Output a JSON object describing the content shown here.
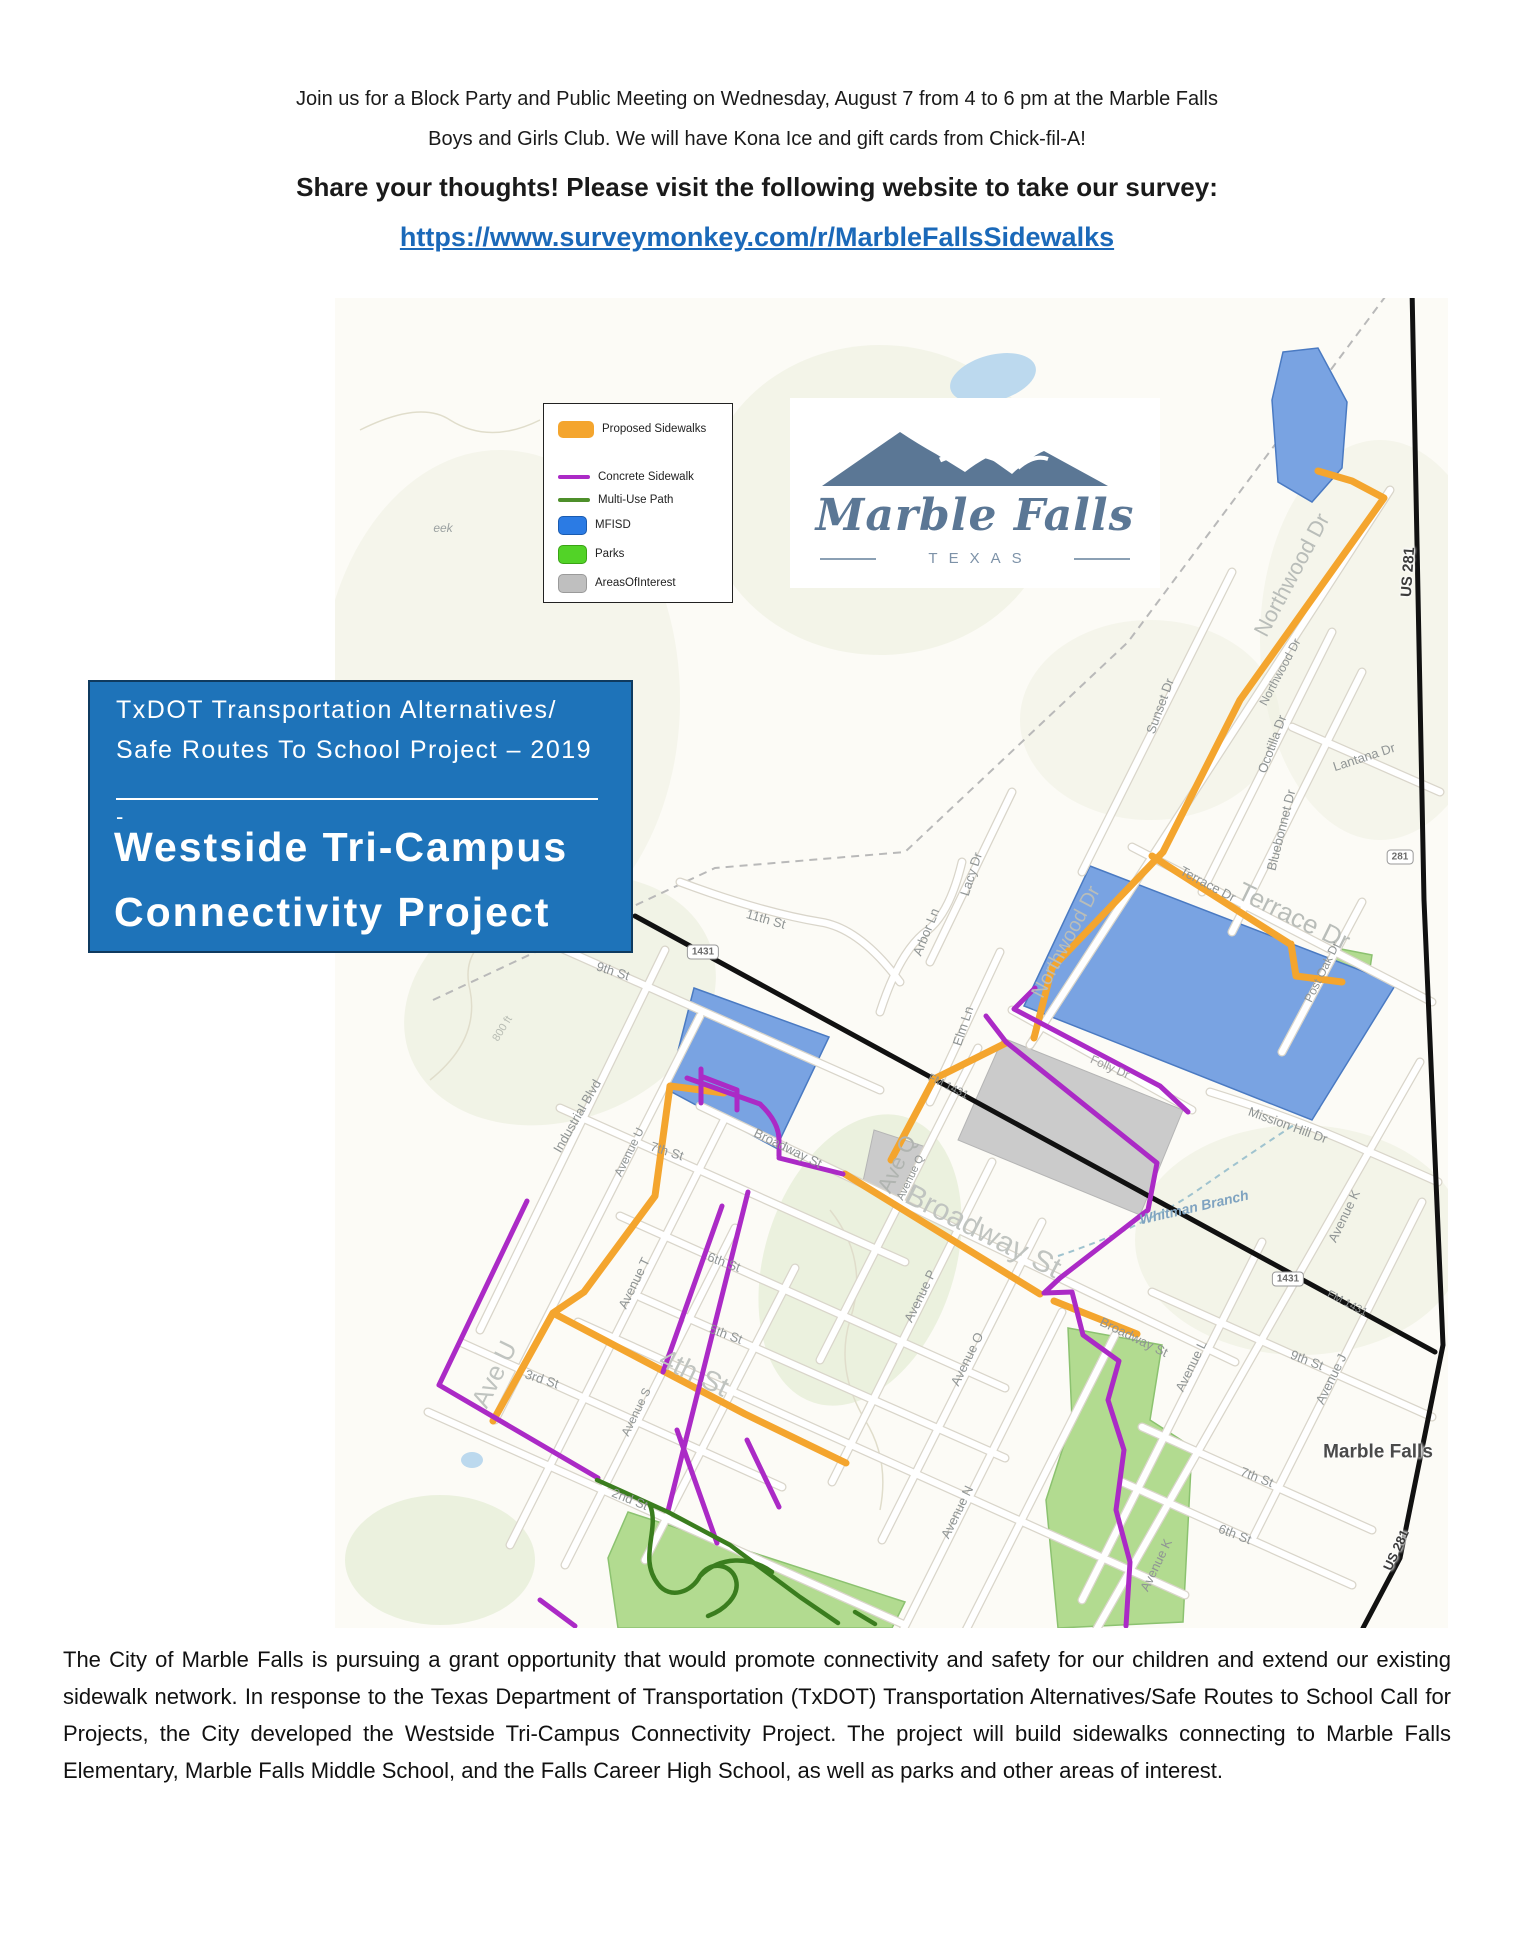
{
  "colors": {
    "proposed_sidewalks": "#F4A52E",
    "concrete_sidewalk": "#AB2AC6",
    "multi_use_path": "#3A7D1E",
    "mfisd_blue": "#2B7BE4",
    "parks_green": "#52D327",
    "areas_of_interest_gray": "#BFBFBF",
    "link_blue": "#1B69B9",
    "project_box_blue": "#1E73B9",
    "logo_slate": "#5B7795",
    "highway_black": "#111111"
  },
  "header": {
    "line1": "Join us for a Block Party and Public Meeting on Wednesday, August 7 from 4 to 6 pm at the Marble Falls",
    "line2": "Boys and Girls Club.  We will have Kona Ice and gift cards from Chick-fil-A!",
    "cta": "Share your thoughts!  Please visit the following website to take our survey:",
    "survey_url": "https://www.surveymonkey.com/r/MarbleFallsSidewalks",
    "questions_prefix": "Questions?  Contact City Engineer Kacey Paul at ",
    "contact_email": "kpaul@marblefallstx.gov",
    "questions_suffix": "."
  },
  "legend": {
    "items": [
      {
        "label": "Proposed Sidewalks",
        "swatch": "orange-rect"
      },
      {
        "label": "Concrete Sidewalk",
        "swatch": "purple-line"
      },
      {
        "label": "Multi-Use Path",
        "swatch": "green-line"
      },
      {
        "label": "MFISD",
        "swatch": "blue-rect"
      },
      {
        "label": "Parks",
        "swatch": "green-rect"
      },
      {
        "label": "AreasOfInterest",
        "swatch": "gray-rect"
      }
    ]
  },
  "logo": {
    "name": "Marble Falls",
    "subtitle": "TEXAS"
  },
  "project_box": {
    "line1": "TxDOT Transportation Alternatives/",
    "line2": "Safe Routes To School Project – 2019",
    "dash": "-",
    "title_line1": "Westside Tri-Campus",
    "title_line2": "Connectivity Project"
  },
  "map": {
    "labels": [
      {
        "text": "eek"
      },
      {
        "text": "Northwood Dr"
      },
      {
        "text": "Northwood Dr"
      },
      {
        "text": "Northwood Dr"
      },
      {
        "text": "US 281"
      },
      {
        "text": "Sunset Dr"
      },
      {
        "text": "Ocotilla Dr"
      },
      {
        "text": "Lantana Dr"
      },
      {
        "text": "Bluebonnet Dr"
      },
      {
        "text": "Terrace Dr"
      },
      {
        "text": "Terrace Dr"
      },
      {
        "text": "Post Oak Dr"
      },
      {
        "text": "Lacy Dr"
      },
      {
        "text": "Arbor Ln"
      },
      {
        "text": "Elm Ln"
      },
      {
        "text": "11th St"
      },
      {
        "text": "9th St"
      },
      {
        "text": "800 ft"
      },
      {
        "text": "Industrial Blvd"
      },
      {
        "text": "Avenue U"
      },
      {
        "text": "7th St"
      },
      {
        "text": "Ave U"
      },
      {
        "text": "4th St"
      },
      {
        "text": "Avenue T"
      },
      {
        "text": "6th St"
      },
      {
        "text": "5th St"
      },
      {
        "text": "3rd St"
      },
      {
        "text": "Avenue S"
      },
      {
        "text": "2nd St"
      },
      {
        "text": "Broadway St"
      },
      {
        "text": "Broadway St"
      },
      {
        "text": "Broadway St"
      },
      {
        "text": "Ave Q"
      },
      {
        "text": "Avenue Q"
      },
      {
        "text": "Avenue P"
      },
      {
        "text": "Avenue O"
      },
      {
        "text": "Avenue N"
      },
      {
        "text": "Avenue L"
      },
      {
        "text": "Avenue K"
      },
      {
        "text": "Avenue K"
      },
      {
        "text": "Avenue J"
      },
      {
        "text": "9th St"
      },
      {
        "text": "7th St"
      },
      {
        "text": "6th St"
      },
      {
        "text": "Mission Hill Dr"
      },
      {
        "text": "Whitman Branch"
      },
      {
        "text": "Folly Dr"
      },
      {
        "text": "Marble Falls"
      },
      {
        "text": "FM 1431"
      },
      {
        "text": "FM 1431"
      },
      {
        "text": "US 281"
      }
    ],
    "shields": [
      {
        "text": "1431"
      },
      {
        "text": "1431"
      },
      {
        "text": "281"
      }
    ]
  },
  "footer": {
    "paragraph": "The City of Marble Falls is pursuing a grant opportunity that would promote connectivity and safety for our children and extend our existing sidewalk network.  In response to the Texas Department of Transportation (TxDOT) Transportation Alternatives/Safe Routes to School Call for Projects, the City developed the Westside Tri-Campus Connectivity Project.  The project will build sidewalks connecting to Marble Falls Elementary, Marble Falls Middle School, and the Falls Career High School, as well as parks and other areas of interest."
  }
}
